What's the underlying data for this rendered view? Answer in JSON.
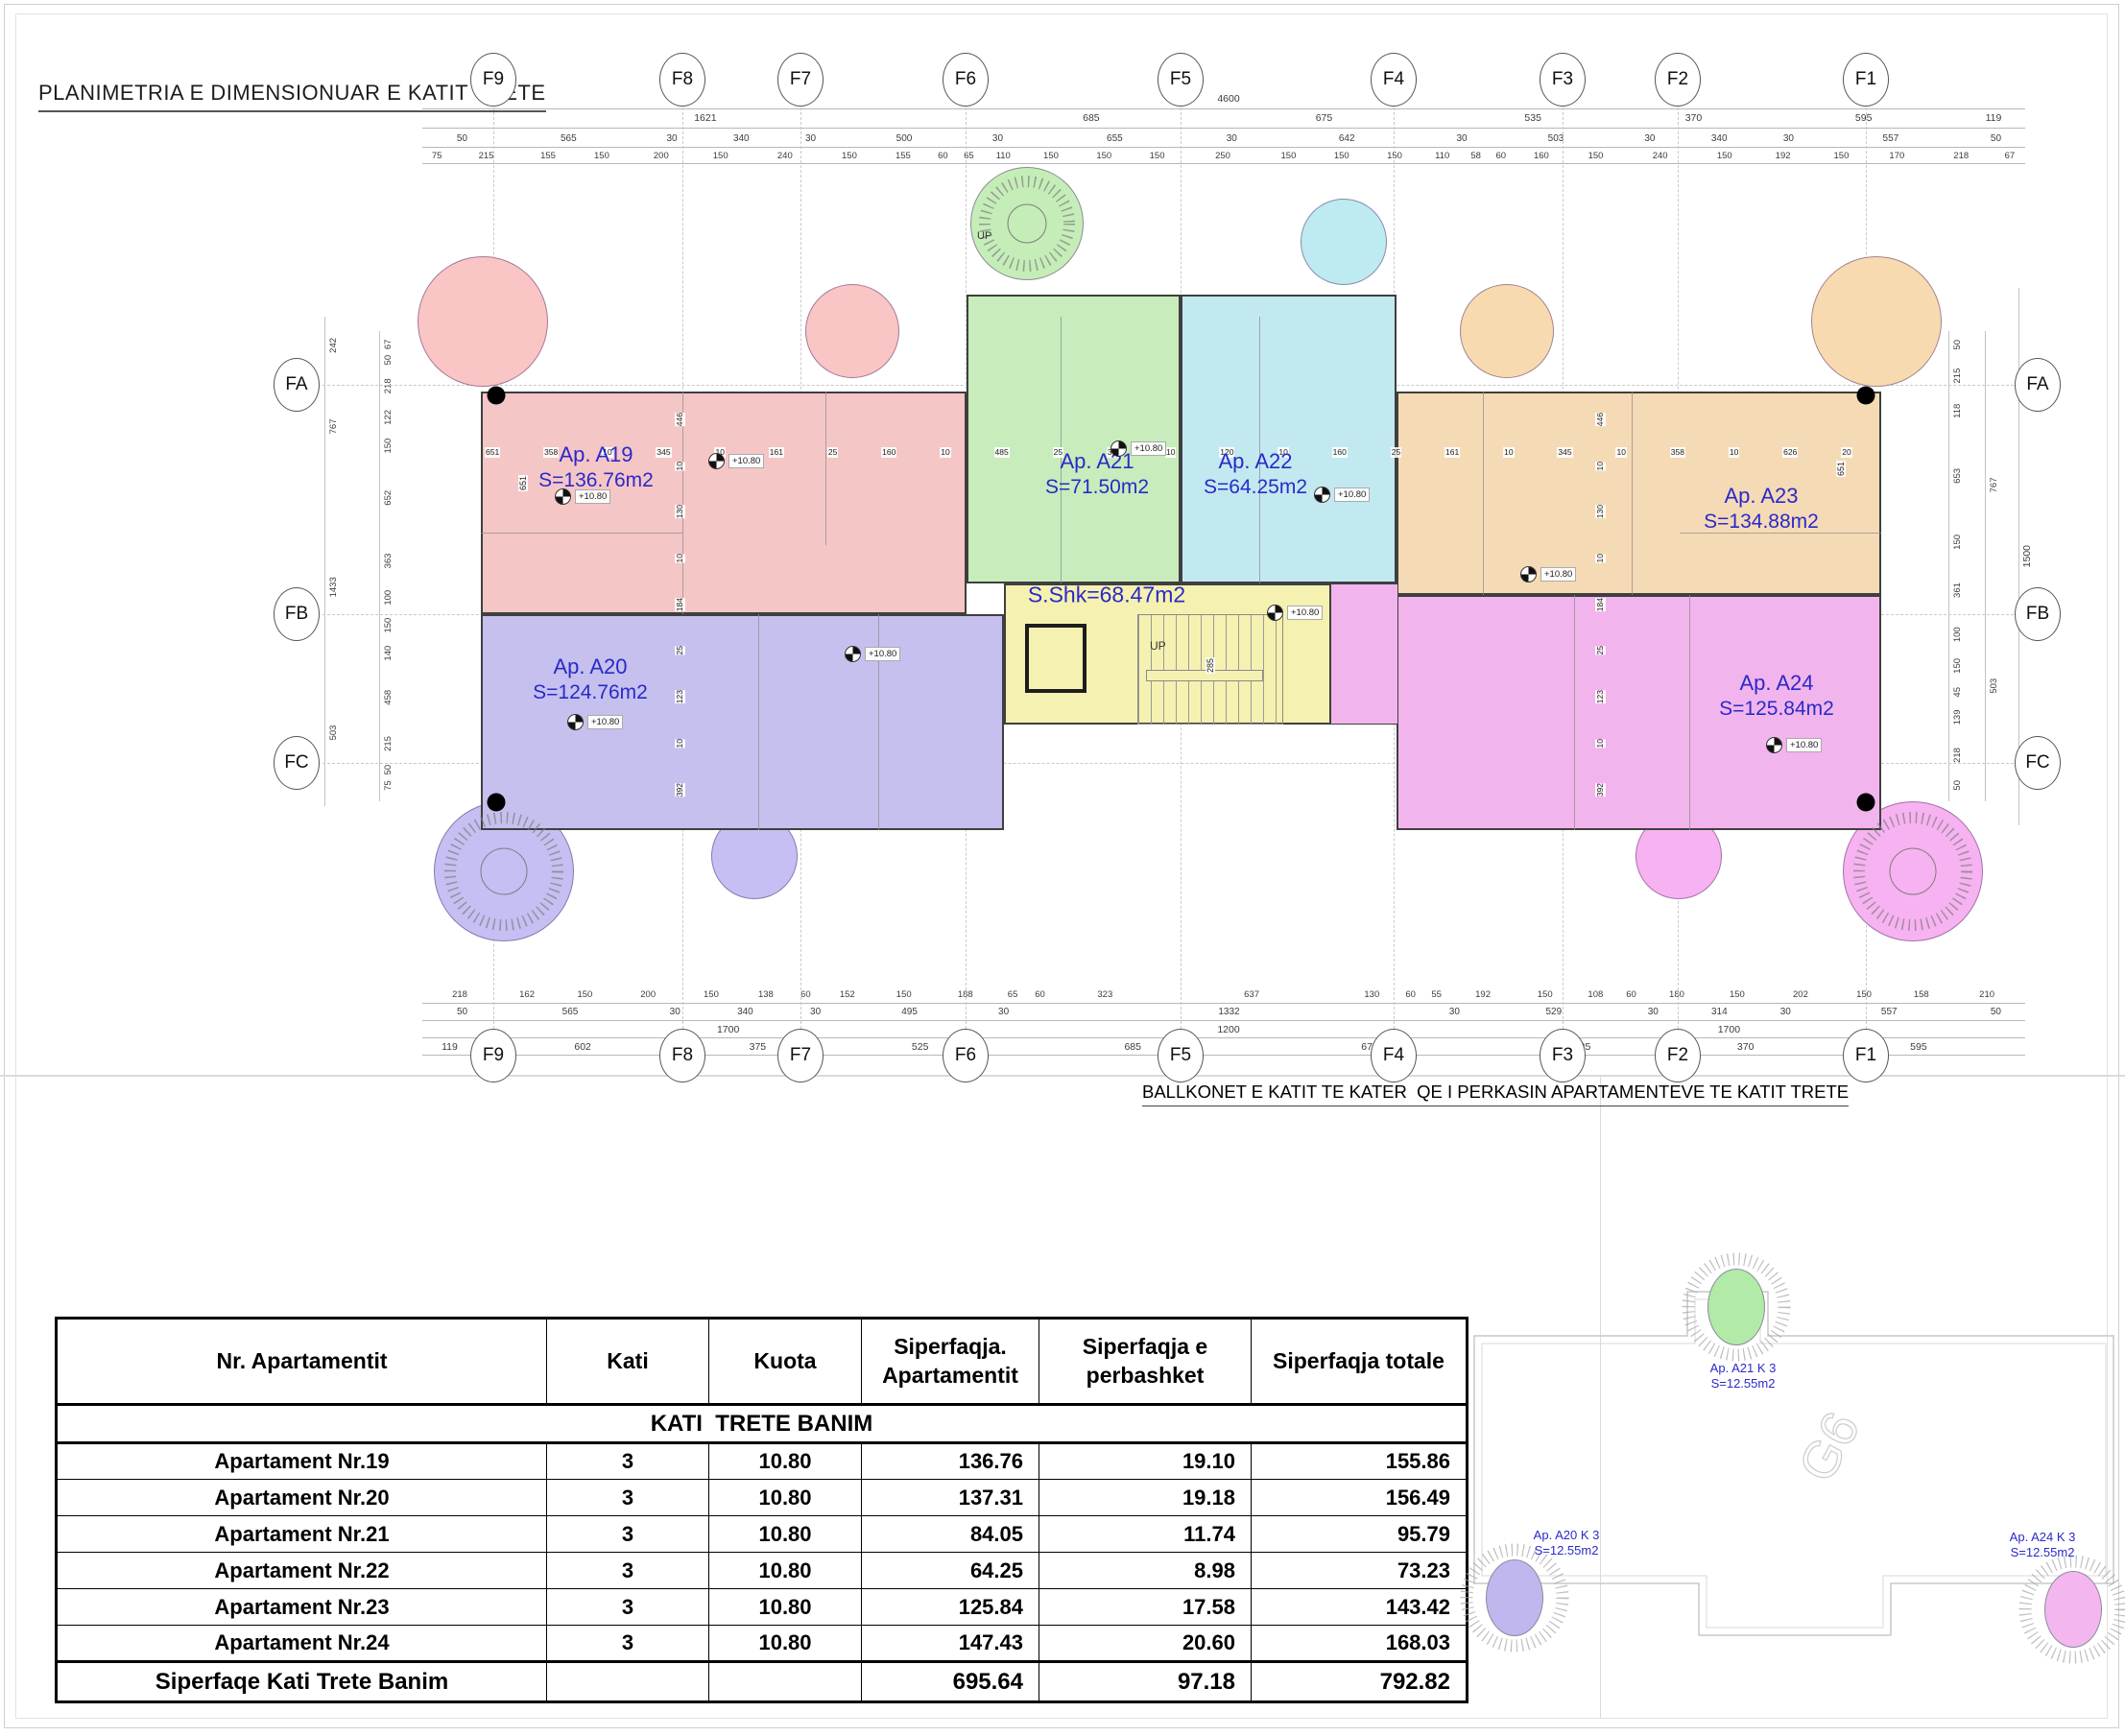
{
  "sheet": {
    "title": "PLANIMETRIA E DIMENSIONUAR E KATIT TRETE",
    "balconies_note": "BALLKONET E KATIT TE KATER  QE I PERKASIN APARTAMENTEVE TE KATIT TRETE"
  },
  "grid": {
    "cols": [
      "F9",
      "F8",
      "F7",
      "F6",
      "F5",
      "F4",
      "F3",
      "F2",
      "F1"
    ],
    "rows": [
      "FA",
      "FB",
      "FC"
    ]
  },
  "plan": {
    "level_label": "+10.80",
    "up_label": "UP",
    "stair_dim": "285",
    "apartments": [
      {
        "id": "A19",
        "name": "Ap. A19",
        "area": "S=136.76m2",
        "color": "#f5c6c6"
      },
      {
        "id": "A20",
        "name": "Ap. A20",
        "area": "S=124.76m2",
        "color": "#c5c0ee"
      },
      {
        "id": "A21",
        "name": "Ap. A21",
        "area": "S=71.50m2",
        "color": "#c8ecbc"
      },
      {
        "id": "A22",
        "name": "Ap. A22",
        "area": "S=64.25m2",
        "color": "#c2e9f0"
      },
      {
        "id": "A23",
        "name": "Ap. A23",
        "area": "S=134.88m2",
        "color": "#f5dab6"
      },
      {
        "id": "A24",
        "name": "Ap. A24",
        "area": "S=125.84m2",
        "color": "#f2b4ec"
      }
    ],
    "core": {
      "label": "S.Shk=68.47m2",
      "color": "#f5f1b0"
    }
  },
  "dims": {
    "top_overall": [
      "4600"
    ],
    "top_spans": [
      "1621",
      "685",
      "675",
      "535",
      "370",
      "595",
      "119"
    ],
    "top_axis": [
      "50",
      "565",
      "30",
      "340",
      "30",
      "500",
      "30",
      "655",
      "30",
      "642",
      "30",
      "503",
      "30",
      "340",
      "30",
      "557",
      "50"
    ],
    "top_detail": [
      "75",
      "215",
      "155",
      "150",
      "200",
      "150",
      "240",
      "150",
      "155",
      "60",
      "65",
      "110",
      "150",
      "150",
      "150",
      "250",
      "150",
      "150",
      "150",
      "110",
      "58",
      "60",
      "160",
      "150",
      "240",
      "150",
      "192",
      "150",
      "170",
      "218",
      "67"
    ],
    "bottom_detail": [
      "218",
      "162",
      "150",
      "200",
      "150",
      "138",
      "60",
      "152",
      "150",
      "188",
      "65",
      "60",
      "323",
      "637",
      "130",
      "60",
      "55",
      "192",
      "150",
      "108",
      "60",
      "180",
      "150",
      "202",
      "150",
      "158",
      "210"
    ],
    "bottom_axis": [
      "50",
      "565",
      "30",
      "340",
      "30",
      "495",
      "30",
      "1332",
      "30",
      "529",
      "30",
      "314",
      "30",
      "557",
      "50"
    ],
    "bottom_spans": [
      "1700",
      "1200",
      "1700"
    ],
    "bottom_totals": [
      "119",
      "602",
      "375",
      "525",
      "685",
      "675",
      "535",
      "370",
      "595"
    ],
    "left_outer": [
      "242",
      "767",
      "1433",
      "503"
    ],
    "left_inner": [
      "67",
      "50",
      "218",
      "122",
      "150",
      "652",
      "363",
      "100",
      "150",
      "140",
      "458",
      "215",
      "50",
      "75"
    ],
    "right_inner": [
      "50",
      "215",
      "118",
      "653",
      "150",
      "361",
      "100",
      "150",
      "45",
      "139",
      "218",
      "50"
    ],
    "right_mid": [
      "767",
      "503"
    ],
    "right_outer": [
      "1500"
    ],
    "interior_h": [
      "651",
      "358",
      "10",
      "345",
      "10",
      "161",
      "25",
      "160",
      "10",
      "485",
      "25",
      "355",
      "10",
      "120",
      "10",
      "160",
      "25",
      "161",
      "10",
      "345",
      "10",
      "358",
      "10",
      "626",
      "20"
    ],
    "interior_v_left": [
      "446",
      "10",
      "130",
      "10",
      "184",
      "25",
      "123",
      "10",
      "392"
    ],
    "interior_v_right": [
      "446",
      "10",
      "130",
      "10",
      "184",
      "25",
      "123",
      "10",
      "392"
    ],
    "wall_tag_left": "651",
    "wall_tag_right": "651"
  },
  "table": {
    "headers": [
      "Nr. Apartamentit",
      "Kati",
      "Kuota",
      "Siperfaqja.\nApartamentit",
      "Siperfaqja e\nperbashket",
      "Siperfaqja totale"
    ],
    "section": "KATI  TRETE BANIM",
    "rows": [
      {
        "name": "Apartament Nr.19",
        "kati": "3",
        "kuota": "10.80",
        "s_ap": "136.76",
        "s_per": "19.10",
        "s_tot": "155.86"
      },
      {
        "name": "Apartament Nr.20",
        "kati": "3",
        "kuota": "10.80",
        "s_ap": "137.31",
        "s_per": "19.18",
        "s_tot": "156.49"
      },
      {
        "name": "Apartament Nr.21",
        "kati": "3",
        "kuota": "10.80",
        "s_ap": "84.05",
        "s_per": "11.74",
        "s_tot": "95.79"
      },
      {
        "name": "Apartament Nr.22",
        "kati": "3",
        "kuota": "10.80",
        "s_ap": "64.25",
        "s_per": "8.98",
        "s_tot": "73.23"
      },
      {
        "name": "Apartament Nr.23",
        "kati": "3",
        "kuota": "10.80",
        "s_ap": "125.84",
        "s_per": "17.58",
        "s_tot": "143.42"
      },
      {
        "name": "Apartament Nr.24",
        "kati": "3",
        "kuota": "10.80",
        "s_ap": "147.43",
        "s_per": "20.60",
        "s_tot": "168.03"
      }
    ],
    "total": {
      "name": "Siperfaqe Kati Trete Banim",
      "s_ap": "695.64",
      "s_per": "97.18",
      "s_tot": "792.82"
    }
  },
  "mini_plan": {
    "watermark": "G6",
    "balconies": [
      {
        "name": "Ap. A21 K 3",
        "area": "S=12.55m2",
        "color": "#b2eaa8"
      },
      {
        "name": "Ap. A20 K 3",
        "area": "S=12.55m2",
        "color": "#bfb7ee"
      },
      {
        "name": "Ap. A24 K 3",
        "area": "S=12.55m2",
        "color": "#f4b6ee"
      }
    ]
  }
}
